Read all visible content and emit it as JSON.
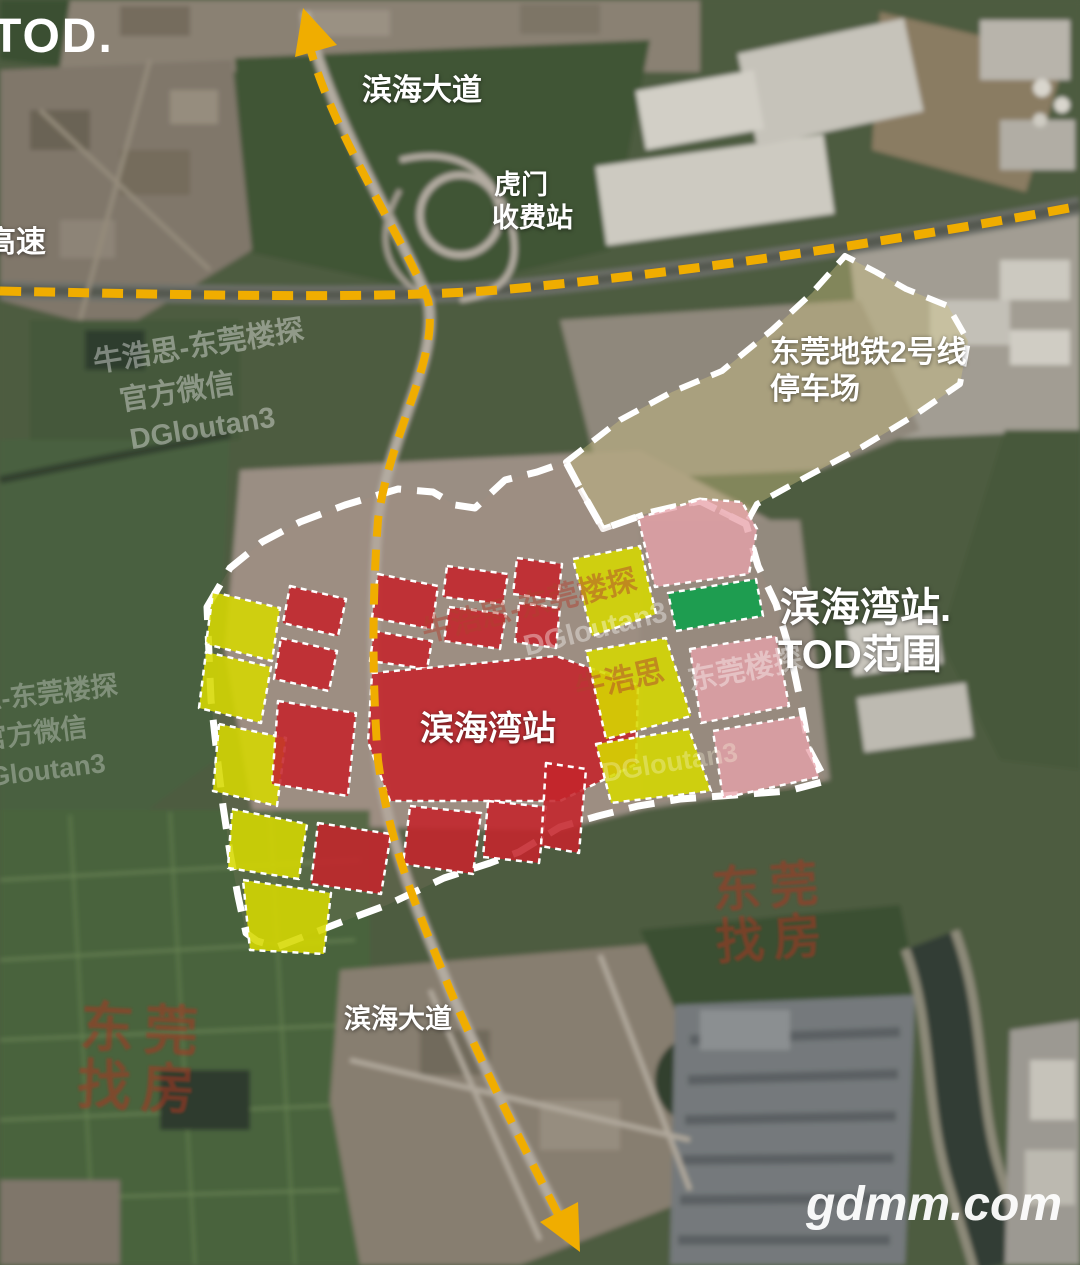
{
  "colors": {
    "parcel_red": "#c4242b",
    "parcel_yellow": "#d6d800",
    "parcel_pink": "#e8a3ab",
    "parcel_green": "#149e4c",
    "route_yellow": "#f0ad00",
    "boundary_white": "#ffffff",
    "stamp_red": "#a83524"
  },
  "labels": {
    "tod_logo": "TOD.",
    "expressway": "高速",
    "binhai_avenue_top": "滨海大道",
    "humen_toll_line1": "虎门",
    "humen_toll_line2": "收费站",
    "metro_depot_line1": "东莞地铁2号线",
    "metro_depot_line2": "停车场",
    "tod_range_line1": "滨海湾站.",
    "tod_range_line2": "TOD范围",
    "station_parcel": "滨海湾站",
    "binhai_avenue_bottom": "滨海大道"
  },
  "watermarks": {
    "brand_line": "牛浩思-东莞楼探",
    "wechat_line": "官方微信",
    "wechat_id": "DGloutan3",
    "brand_short": "牛浩思",
    "brand_media": "东莞楼探",
    "site": "gdmm.com",
    "stamp_chars": [
      "东",
      "莞",
      "找",
      "房"
    ]
  }
}
